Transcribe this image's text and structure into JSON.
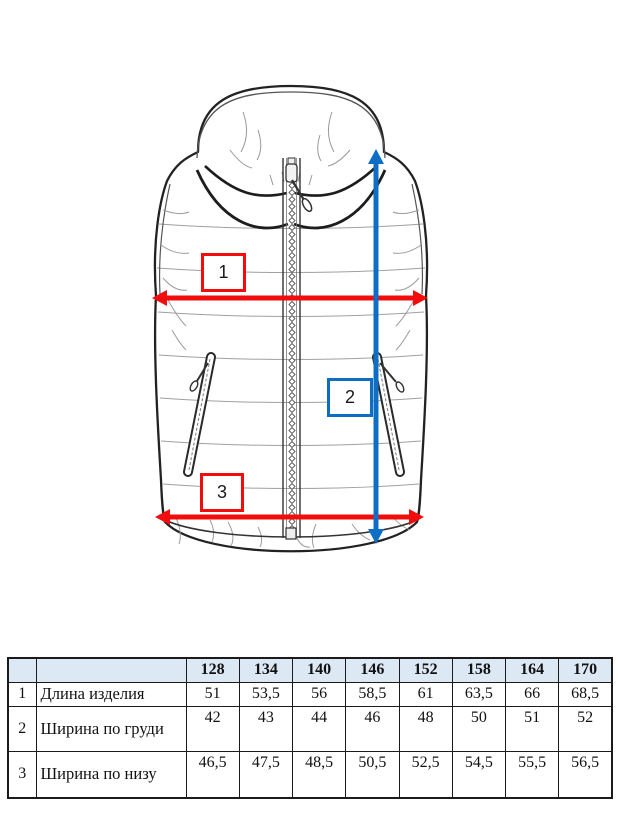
{
  "colors": {
    "annotation_red": "#f20d0d",
    "annotation_blue": "#0e6ec4",
    "table_header_bg": "#dce9f5",
    "line_art": "#222222"
  },
  "drawing": {
    "description": "technical flat sketch of hooded puffer vest with measurement arrows",
    "callouts": [
      {
        "id": "1",
        "color": "red",
        "measure": "horizontal chest arrow"
      },
      {
        "id": "2",
        "color": "blue",
        "measure": "vertical length arrow"
      },
      {
        "id": "3",
        "color": "red",
        "measure": "horizontal hem arrow"
      }
    ]
  },
  "table": {
    "corner": "",
    "sizes": [
      "128",
      "134",
      "140",
      "146",
      "152",
      "158",
      "164",
      "170"
    ],
    "rows": [
      {
        "num": "1",
        "label": "Длина изделия",
        "values": [
          "51",
          "53,5",
          "56",
          "58,5",
          "61",
          "63,5",
          "66",
          "68,5"
        ]
      },
      {
        "num": "2",
        "label": "Ширина по груди",
        "values": [
          "42",
          "43",
          "44",
          "46",
          "48",
          "50",
          "51",
          "52"
        ]
      },
      {
        "num": "3",
        "label": "Ширина по низу",
        "values": [
          "46,5",
          "47,5",
          "48,5",
          "50,5",
          "52,5",
          "54,5",
          "55,5",
          "56,5"
        ]
      }
    ]
  }
}
